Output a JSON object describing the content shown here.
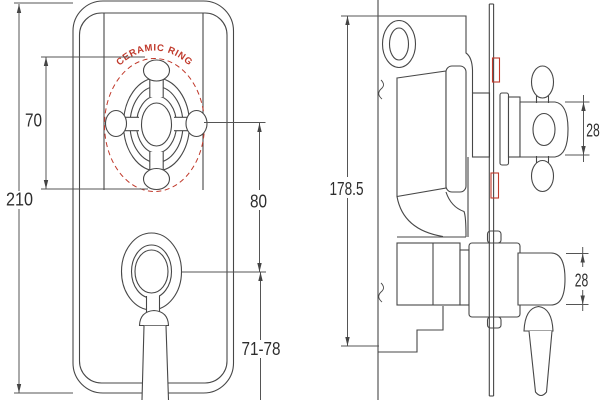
{
  "front_view": {
    "ceramic_ring_label": "CERAMIC RING",
    "dim_overall_height": "210",
    "dim_handle_height": "70",
    "dim_handle_to_lever": "80",
    "dim_lever_clearance": "71-78"
  },
  "side_view": {
    "dim_body_height": "178.5",
    "dim_top_handle_dia": "28",
    "dim_bottom_handle_dia": "28"
  },
  "colors": {
    "accent_red": "#c0392b",
    "line": "#474747",
    "dim_line": "#555555",
    "text": "#2e2e2e"
  }
}
